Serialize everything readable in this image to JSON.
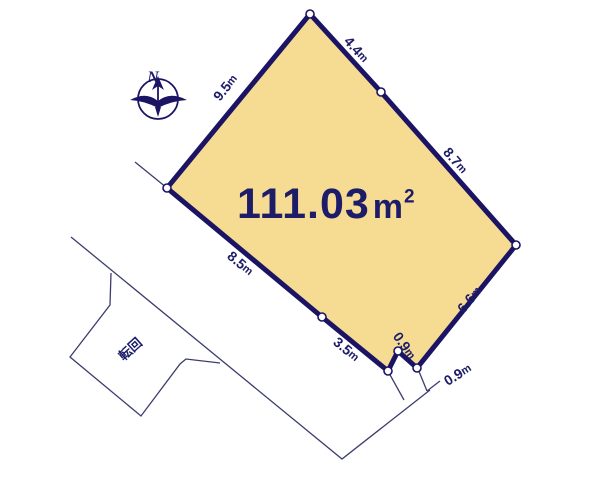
{
  "colors": {
    "background": "#ffffff",
    "lot_fill": "#f6db92",
    "border_navy": "#1b1464",
    "text_navy": "#1c1c69",
    "thin_line": "#3c3c6e"
  },
  "compass": {
    "label": "N"
  },
  "area_label": {
    "value": "111.03",
    "unit": "m",
    "sup": "2"
  },
  "labels": [
    {
      "text": "9.5m",
      "x": 226,
      "y": 88,
      "rot": -51,
      "kind": "dim"
    },
    {
      "text": "4.4m",
      "x": 356,
      "y": 50,
      "rot": 48,
      "kind": "dim"
    },
    {
      "text": "8.7m",
      "x": 455,
      "y": 161,
      "rot": 49,
      "kind": "dim"
    },
    {
      "text": "6.6m",
      "x": 470,
      "y": 300,
      "rot": -51,
      "kind": "dim"
    },
    {
      "text": "8.5m",
      "x": 240,
      "y": 264,
      "rot": 40,
      "kind": "dim"
    },
    {
      "text": "3.5m",
      "x": 346,
      "y": 350,
      "rot": 40,
      "kind": "dim"
    },
    {
      "text": "0.9m",
      "x": 404,
      "y": 346,
      "rot": 55,
      "kind": "dim"
    },
    {
      "text": "0.9m",
      "x": 458,
      "y": 375,
      "rot": -32,
      "kind": "dim"
    },
    {
      "text": "転回",
      "x": 131,
      "y": 350,
      "rot": -42,
      "kind": "annot"
    }
  ],
  "lot": {
    "polygon_points": "310,14 381,92 516,245 417,368 398,351 388,371 322,317 167,188",
    "vertices": [
      [
        310,
        14
      ],
      [
        381,
        92
      ],
      [
        516,
        245
      ],
      [
        417,
        368
      ],
      [
        398,
        351
      ],
      [
        388,
        371
      ],
      [
        322,
        317
      ],
      [
        167,
        188
      ]
    ]
  }
}
